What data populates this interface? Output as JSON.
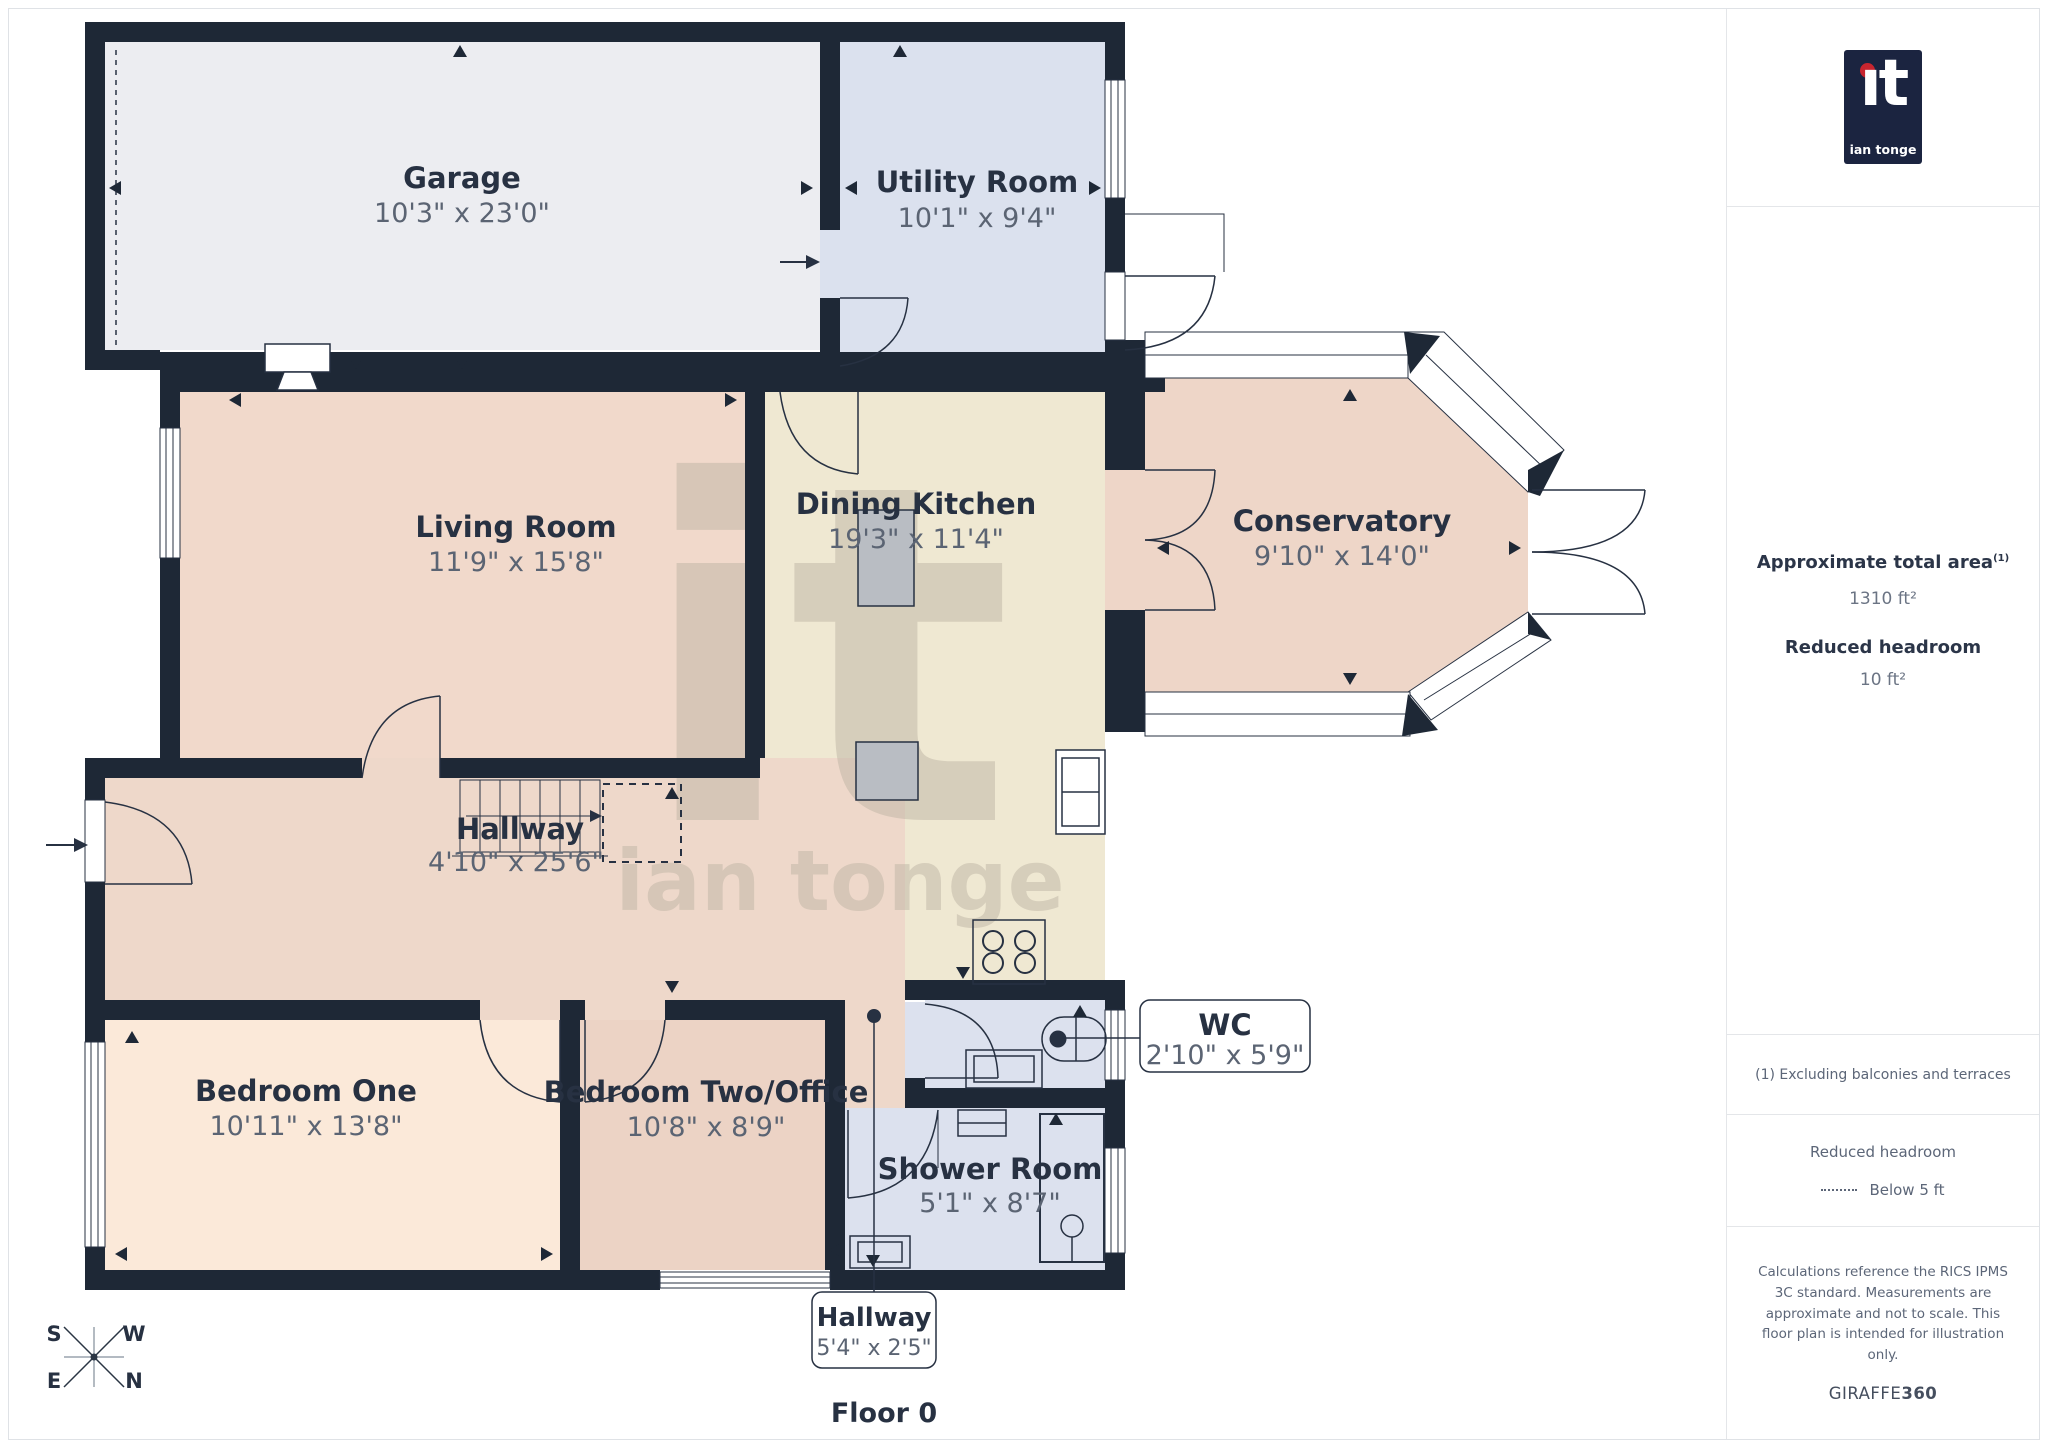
{
  "page": {
    "floor_label": "Floor 0"
  },
  "watermark": {
    "mark": "it",
    "name": "ian tonge"
  },
  "compass": {
    "s": "S",
    "w": "W",
    "e": "E",
    "n": "N"
  },
  "rooms": [
    {
      "name": "Garage",
      "dims": "10'3\" x 23'0\""
    },
    {
      "name": "Utility Room",
      "dims": "10'1\" x 9'4\""
    },
    {
      "name": "Living Room",
      "dims": "11'9\" x 15'8\""
    },
    {
      "name": "Dining Kitchen",
      "dims": "19'3\" x 11'4\""
    },
    {
      "name": "Conservatory",
      "dims": "9'10\" x 14'0\""
    },
    {
      "name": "Hallway",
      "dims": "4'10\" x 25'6\""
    },
    {
      "name": "Bedroom One",
      "dims": "10'11\" x 13'8\""
    },
    {
      "name": "Bedroom Two/Office",
      "dims": "10'8\" x 8'9\""
    },
    {
      "name": "WC",
      "dims": "2'10\" x 5'9\""
    },
    {
      "name": "Shower Room",
      "dims": "5'1\" x 8'7\""
    },
    {
      "name": "Hallway",
      "dims": "5'4\" x 2'5\""
    }
  ],
  "sidebar": {
    "logo": {
      "mark": "ıt",
      "name": "ian tonge"
    },
    "area_title": "Approximate total area",
    "area_sup": "(1)",
    "area_value": "1310 ft²",
    "headroom_title": "Reduced headroom",
    "headroom_value": "10 ft²",
    "note": "(1) Excluding balconies and terraces",
    "legend_title": "Reduced headroom",
    "legend_item": "Below 5 ft",
    "disclaimer": "Calculations reference the RICS IPMS 3C standard. Measurements are approximate and not to scale. This floor plan is intended for illustration only.",
    "brand_name": "GIRAFFE",
    "brand_suffix": "360"
  },
  "colors": {
    "wall": "#1e2836",
    "label": "#273142",
    "dims": "#5b6473",
    "garage": "#ecedf1",
    "utility": "#dbe1ee",
    "living": "#f1d9cb",
    "kitchen": "#efe8d2",
    "conservatory": "#eed6c8",
    "hallway": "#eed8ca",
    "bedroom1": "#fbe9d9",
    "bedroom2": "#ecd3c5",
    "bath": "#dce1ee"
  }
}
